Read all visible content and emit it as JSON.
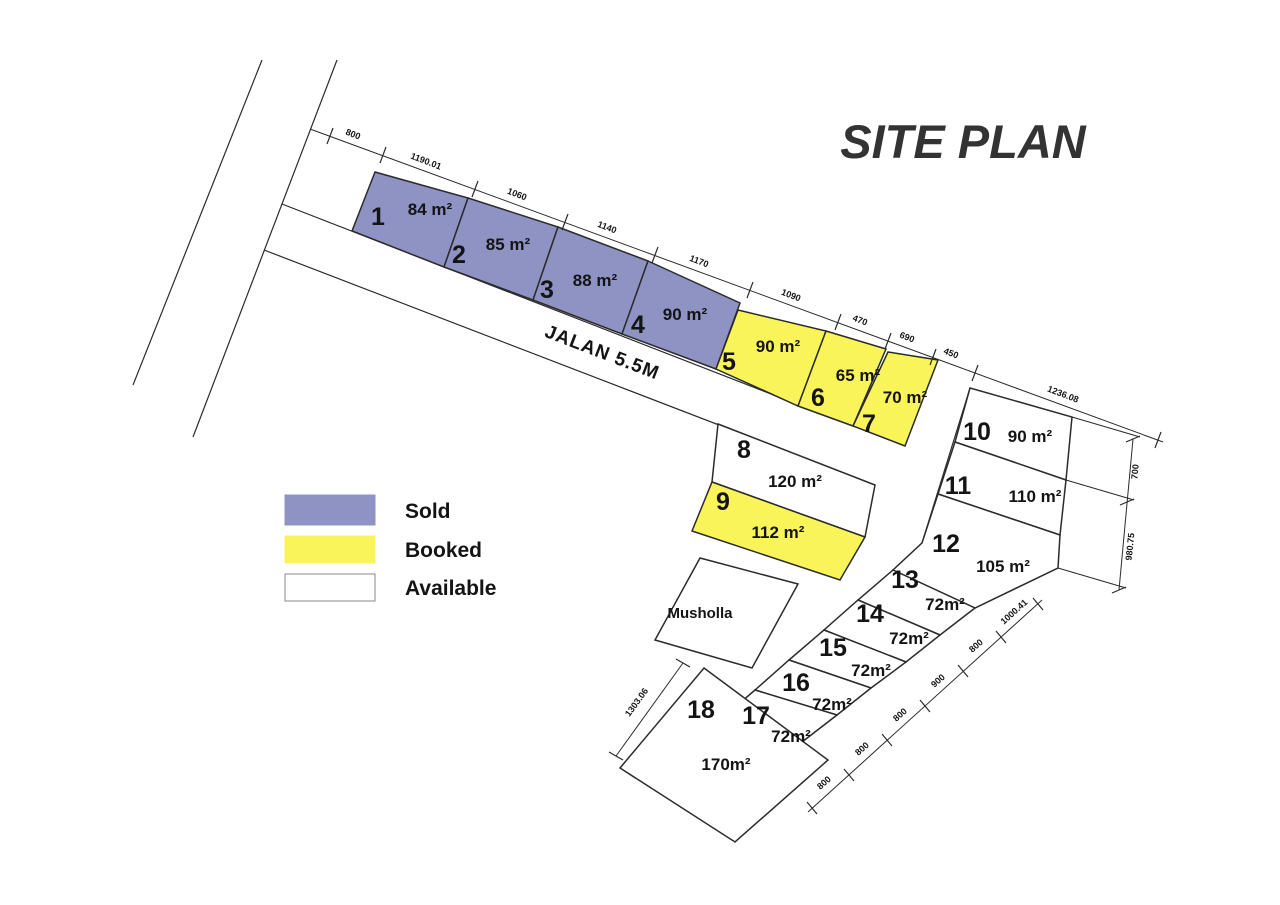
{
  "title": "SITE PLAN",
  "road_label": "JALAN 5.5M",
  "musholla_label": "Musholla",
  "legend": {
    "items": [
      {
        "label": "Sold",
        "status": "sold",
        "color": "#8F93C4"
      },
      {
        "label": "Booked",
        "status": "booked",
        "color": "#F9F45A"
      },
      {
        "label": "Available",
        "status": "available",
        "color": "#FFFFFF"
      }
    ]
  },
  "plots": [
    {
      "num": "1",
      "area": "84 m²",
      "status": "sold"
    },
    {
      "num": "2",
      "area": "85 m²",
      "status": "sold"
    },
    {
      "num": "3",
      "area": "88 m²",
      "status": "sold"
    },
    {
      "num": "4",
      "area": "90 m²",
      "status": "sold"
    },
    {
      "num": "5",
      "area": "90 m²",
      "status": "booked"
    },
    {
      "num": "6",
      "area": "65 m²",
      "status": "booked"
    },
    {
      "num": "7",
      "area": "70 m²",
      "status": "booked"
    },
    {
      "num": "8",
      "area": "120 m²",
      "status": "available"
    },
    {
      "num": "9",
      "area": "112 m²",
      "status": "booked"
    },
    {
      "num": "10",
      "area": "90 m²",
      "status": "available"
    },
    {
      "num": "11",
      "area": "110 m²",
      "status": "available"
    },
    {
      "num": "12",
      "area": "105 m²",
      "status": "available"
    },
    {
      "num": "13",
      "area": "72m²",
      "status": "available"
    },
    {
      "num": "14",
      "area": "72m²",
      "status": "available"
    },
    {
      "num": "15",
      "area": "72m²",
      "status": "available"
    },
    {
      "num": "16",
      "area": "72m²",
      "status": "available"
    },
    {
      "num": "17",
      "area": "72m²",
      "status": "available"
    },
    {
      "num": "18",
      "area": "170m²",
      "status": "available"
    }
  ],
  "dimensions": {
    "top": [
      "800",
      "1190.01",
      "1060",
      "1140",
      "1170",
      "1090",
      "470",
      "690",
      "450",
      "1236.08"
    ],
    "right": [
      "700",
      "980.75"
    ],
    "bottom": [
      "1000.41",
      "800",
      "900",
      "800",
      "800",
      "800"
    ],
    "left": [
      "1303.06"
    ]
  },
  "colors": {
    "sold": "#8F93C4",
    "booked": "#F9F45A",
    "available": "#FFFFFF",
    "line": "#2B2B2B"
  }
}
